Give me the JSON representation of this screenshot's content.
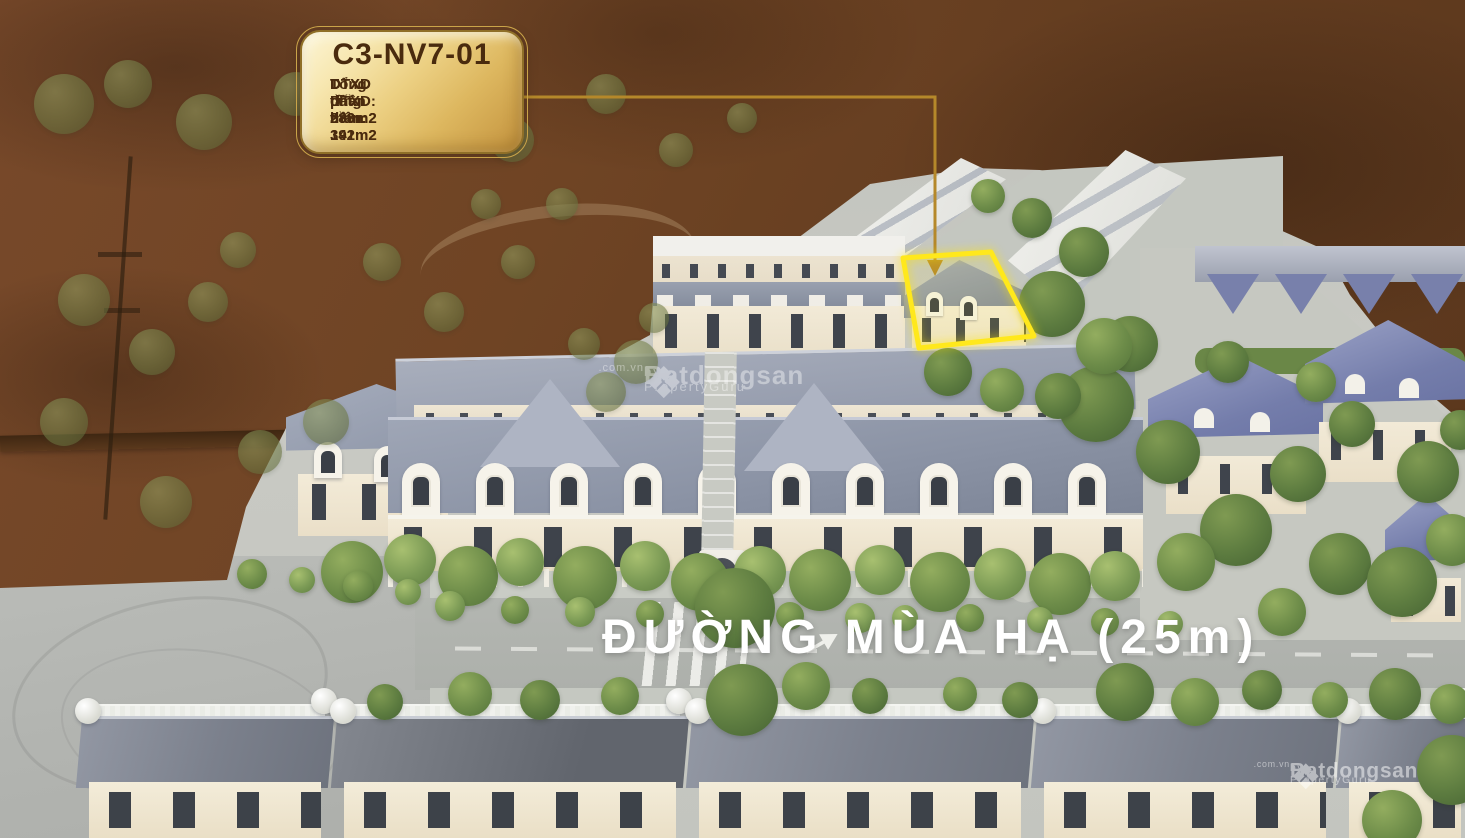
{
  "callout": {
    "title": "C3-NV7-01",
    "lines": [
      "DT đất: 280m2",
      "DTXD phần thân: 391m2",
      "DTXD tầng hầm: 142m2",
      "Tổng DTXD: 533m2"
    ]
  },
  "street_label": "ĐƯỜNG MÙA HẠ (25m)",
  "watermark": {
    "logo_glyph": "❖",
    "brand": "Batdongsan",
    "suffix": ".com.vn",
    "byline": "by PropertyGuru"
  },
  "theme": {
    "accent_gold": "#b5882a",
    "callout_gold_light": "#f9ecc0",
    "callout_gold_dark": "#c3943f",
    "callout_text": "#4a2b0e",
    "highlight_yellow": "#ffe81c",
    "brown_overlay": "#6b4423",
    "roof_blue": "#9aa1b3",
    "roof_indigo": "#7880ab",
    "wall_cream": "#f2e9d5",
    "road_gray": "#b2b5b0",
    "tree_green": "#7b9a55",
    "street_text": "#ffffff"
  }
}
